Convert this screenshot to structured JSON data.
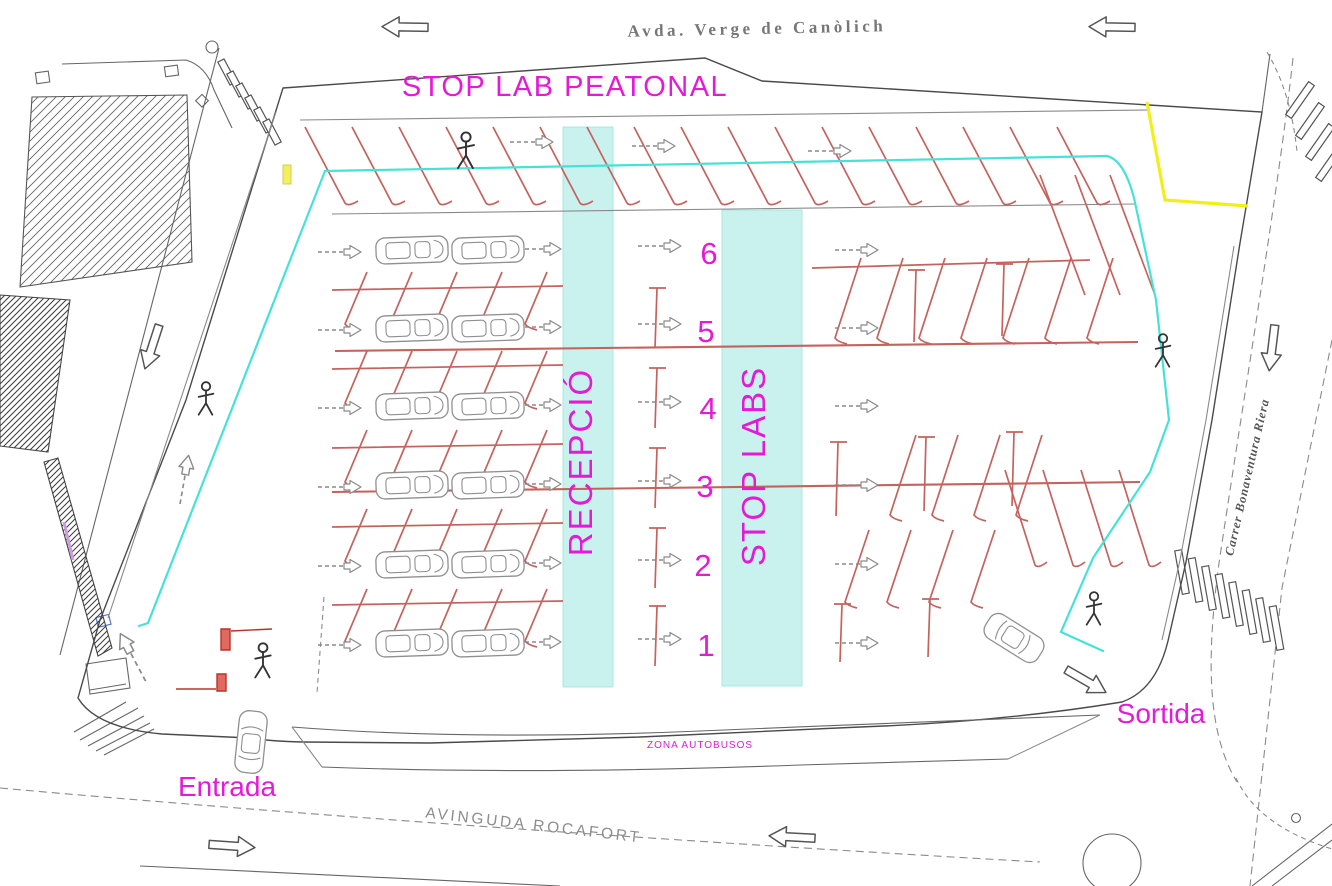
{
  "plan": {
    "streets": {
      "top": "Avda. Verge de Canòlich",
      "bottom": "AVINGUDA ROCAFORT",
      "right": "Carrer Bonaventura Riera"
    },
    "labels": {
      "pedestrian_stop": "STOP LAB PEATONAL",
      "reception_lane": "RECEPCIÓ",
      "stop_labs_lane": "STOP LABS",
      "entrance": "Entrada",
      "exit": "Sortida",
      "bus_zone": "ZONA AUTOBUSOS"
    },
    "lanes": [
      "6",
      "5",
      "4",
      "3",
      "2",
      "1"
    ],
    "icons": {
      "pedestrian": "stick-figure",
      "car_side": "car-outline-side",
      "car_top": "car-outline-top",
      "direction_arrow": "outline-block-arrow",
      "flow_arrow": "dashed-flow-arrow",
      "crosswalk": "zebra-bars",
      "roundabout": "circle-outline"
    },
    "colors": {
      "magenta": "#e41bd6",
      "parking_red": "#c4635d",
      "cyan_line": "#45e2d8",
      "band_fill": "#c9f1ee",
      "yellow": "#f2ef18",
      "line_dark": "#4a4a4a",
      "line_gray": "#8a8a8a",
      "text_gray": "#777777"
    }
  }
}
